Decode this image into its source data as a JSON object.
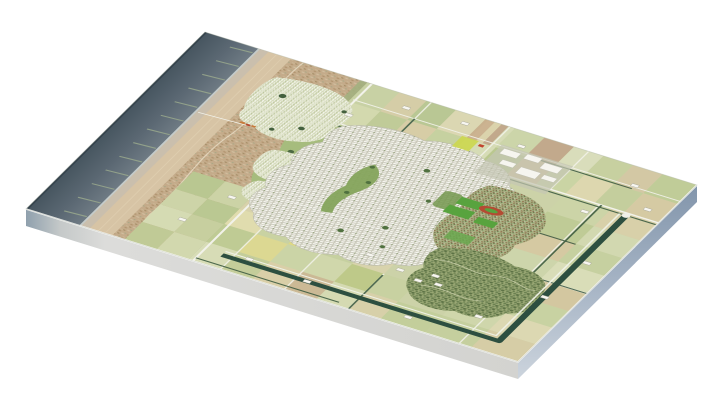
{
  "window": {
    "background": "#ffffff",
    "width": 711,
    "height": 400
  },
  "scene": {
    "kind": "3d-aerial-masterplan-map",
    "plate": {
      "thickness_px": 17,
      "front_face_left_tint": "#8fa0ad",
      "front_face_main": "#dcdcda",
      "front_face_far": "#d3d3d0",
      "right_face_top": "#8295ab",
      "right_face_mid": "#a5b3c4",
      "right_face_bottom": "#ccd4dd",
      "edge_highlight": "#ffffff"
    },
    "colors": {
      "sea_deep": "#46555f",
      "sea_mid": "#5b6873",
      "sea_shore": "#707c85",
      "sea_edge_rim": "#33414b",
      "foam": "#d3d9d6",
      "shoreline": "#e9ebe4",
      "beach": "#d7c4a5",
      "wet_sand": "#c9bfae",
      "beach_streak": "#e4d6b8",
      "dune_base": "#c4ab8a",
      "dune_path": "#e8ddc6",
      "dune_grass": "#a3b080",
      "field_base": "#ccd2a8",
      "road": "#f2f2ea",
      "hedge": "#3e5c41",
      "canal": "#2d4f40",
      "town_background": "#cbcabb",
      "town_building": "#fafaf4",
      "building_shadow": "#a2a296",
      "greenbelt": "#a6bc7d",
      "park": "#85a45c",
      "tree": "#4d6a42",
      "pond": "#2f4a44",
      "sports_field": "#58a33e",
      "running_track": "#b44b33",
      "suburb_background": "#a9b284",
      "suburb_roof": "#8a5c40",
      "forest": "#99a774",
      "forest_path": "#d6d9b8",
      "business_park": "#c4c6b4",
      "bulb_field_yellow": "#ccd74e",
      "shop_roof_orange": "#c77a3a",
      "farm_building": "#f7f6f0",
      "groyne": "#9aa98d"
    },
    "fields": [
      [
        330,
        0,
        65,
        75,
        "#c8d1a4"
      ],
      [
        395,
        0,
        55,
        75,
        "#d5cda7"
      ],
      [
        450,
        0,
        60,
        75,
        "#b9c794"
      ],
      [
        510,
        0,
        60,
        75,
        "#dbd7b2"
      ],
      [
        570,
        0,
        60,
        75,
        "#c9b18e"
      ],
      [
        630,
        0,
        60,
        75,
        "#ccd5a9"
      ],
      [
        690,
        0,
        60,
        75,
        "#c2a98c"
      ],
      [
        750,
        0,
        60,
        75,
        "#d9ddbb"
      ],
      [
        810,
        0,
        60,
        75,
        "#c7d0a0"
      ],
      [
        870,
        0,
        60,
        75,
        "#d3c8a4"
      ],
      [
        930,
        0,
        70,
        75,
        "#c0cc98"
      ],
      [
        575,
        0,
        14,
        75,
        "#ccb391"
      ],
      [
        589,
        0,
        14,
        75,
        "#dbd3ac"
      ],
      [
        603,
        0,
        14,
        75,
        "#c2a98c"
      ],
      [
        617,
        0,
        13,
        75,
        "#d6dcb6"
      ],
      [
        330,
        75,
        65,
        75,
        "#d3d9ae"
      ],
      [
        395,
        75,
        55,
        75,
        "#c0cb98"
      ],
      [
        450,
        75,
        60,
        75,
        "#d7cda6"
      ],
      [
        510,
        75,
        60,
        75,
        "#c6d1a0"
      ],
      [
        570,
        75,
        60,
        75,
        "#d6dcb6"
      ],
      [
        630,
        75,
        60,
        75,
        "#bac88f"
      ],
      [
        690,
        75,
        60,
        75,
        "#d2c09b"
      ],
      [
        750,
        75,
        60,
        75,
        "#cad4a4"
      ],
      [
        810,
        75,
        60,
        75,
        "#ddd7af"
      ],
      [
        870,
        75,
        60,
        75,
        "#c4ce9d"
      ],
      [
        930,
        75,
        70,
        75,
        "#d5caa3"
      ],
      [
        810,
        150,
        95,
        70,
        "#ccd4a7"
      ],
      [
        905,
        150,
        95,
        70,
        "#d8d0a9"
      ],
      [
        810,
        220,
        95,
        70,
        "#bfcb96"
      ],
      [
        905,
        220,
        95,
        70,
        "#d2d8b0"
      ],
      [
        810,
        290,
        95,
        70,
        "#d5c9a2"
      ],
      [
        905,
        290,
        95,
        70,
        "#c6d0a0"
      ],
      [
        810,
        360,
        95,
        70,
        "#cdd5ab"
      ],
      [
        905,
        360,
        95,
        70,
        "#d9ddb8"
      ],
      [
        810,
        430,
        95,
        70,
        "#c2cd99"
      ],
      [
        905,
        430,
        95,
        70,
        "#d3c7a0"
      ],
      [
        810,
        500,
        95,
        65,
        "#d7dbb4"
      ],
      [
        905,
        500,
        95,
        65,
        "#c8d2a2"
      ],
      [
        810,
        565,
        95,
        65,
        "#cfd6ab"
      ],
      [
        905,
        565,
        95,
        65,
        "#dcd8b2"
      ],
      [
        810,
        630,
        95,
        70,
        "#c5cf9e"
      ],
      [
        905,
        630,
        95,
        70,
        "#d6cda6"
      ],
      [
        330,
        150,
        70,
        90,
        "#b4c48d"
      ],
      [
        330,
        240,
        70,
        90,
        "#c3cf9c"
      ],
      [
        330,
        330,
        70,
        100,
        "#abbc82"
      ],
      [
        200,
        430,
        65,
        70,
        "#b9c791"
      ],
      [
        265,
        430,
        65,
        70,
        "#ccd3a6"
      ],
      [
        330,
        430,
        65,
        70,
        "#d8d2ab"
      ],
      [
        200,
        500,
        65,
        60,
        "#cdd4a8"
      ],
      [
        265,
        500,
        65,
        60,
        "#bac892"
      ],
      [
        200,
        560,
        65,
        70,
        "#d5dbb3"
      ],
      [
        265,
        560,
        65,
        70,
        "#c7cf9f"
      ],
      [
        200,
        630,
        65,
        70,
        "#c0ca96"
      ],
      [
        265,
        630,
        65,
        70,
        "#d2d8ae"
      ],
      [
        330,
        500,
        65,
        60,
        "#e0dcae"
      ],
      [
        395,
        500,
        65,
        60,
        "#c9d2a2"
      ],
      [
        460,
        500,
        65,
        60,
        "#d4c9a2"
      ],
      [
        330,
        560,
        65,
        70,
        "#bfcb94"
      ],
      [
        395,
        560,
        65,
        70,
        "#dcd892"
      ],
      [
        460,
        560,
        65,
        70,
        "#cbd4a6"
      ],
      [
        330,
        630,
        65,
        70,
        "#d7dcb6"
      ],
      [
        395,
        630,
        65,
        70,
        "#c4cd9a"
      ],
      [
        460,
        630,
        65,
        70,
        "#d9cfa8"
      ],
      [
        525,
        500,
        65,
        60,
        "#c6d0a0"
      ],
      [
        590,
        500,
        65,
        60,
        "#d8d3ac"
      ],
      [
        525,
        560,
        65,
        70,
        "#d0d7ab"
      ],
      [
        590,
        560,
        65,
        70,
        "#bec989"
      ],
      [
        525,
        630,
        65,
        70,
        "#cbb995"
      ],
      [
        590,
        630,
        65,
        70,
        "#d5dab2"
      ],
      [
        655,
        560,
        65,
        70,
        "#c8d1a1"
      ],
      [
        655,
        630,
        65,
        70,
        "#d7d0a9"
      ],
      [
        720,
        630,
        90,
        70,
        "#c3ce9b"
      ],
      [
        460,
        500,
        16,
        60,
        "#ded884"
      ],
      [
        476,
        500,
        16,
        60,
        "#e6e2bd"
      ],
      [
        492,
        500,
        16,
        60,
        "#b9c98c"
      ],
      [
        508,
        500,
        17,
        60,
        "#d6cda0"
      ]
    ],
    "hedges": [
      [
        335,
        158,
        560,
        158
      ],
      [
        640,
        158,
        1005,
        158
      ],
      [
        700,
        72,
        905,
        72
      ],
      [
        884,
        150,
        884,
        430
      ],
      [
        339,
        688,
        630,
        688
      ],
      [
        343,
        152,
        343,
        428
      ],
      [
        460,
        65,
        460,
        150
      ],
      [
        655,
        565,
        655,
        705
      ],
      [
        905,
        430,
        1005,
        430
      ],
      [
        810,
        292,
        905,
        292
      ]
    ],
    "groynes": {
      "ys": [
        18,
        72,
        126,
        180,
        234,
        288,
        342,
        396,
        450,
        504,
        558,
        612,
        666
      ],
      "x_start": 106,
      "x_end": 62,
      "droop": 4
    },
    "farmsteads": [
      [
        430,
        40
      ],
      [
        545,
        32
      ],
      [
        668,
        48
      ],
      [
        905,
        60
      ],
      [
        962,
        120
      ],
      [
        868,
        185
      ],
      [
        952,
        338
      ],
      [
        940,
        480
      ],
      [
        868,
        600
      ],
      [
        760,
        668
      ],
      [
        548,
        655
      ],
      [
        424,
        642
      ],
      [
        300,
        472
      ],
      [
        258,
        585
      ],
      [
        352,
        115
      ],
      [
        604,
        516
      ],
      [
        674,
        533
      ],
      [
        738,
        518
      ],
      [
        756,
        542
      ],
      [
        718,
        548
      ]
    ]
  }
}
